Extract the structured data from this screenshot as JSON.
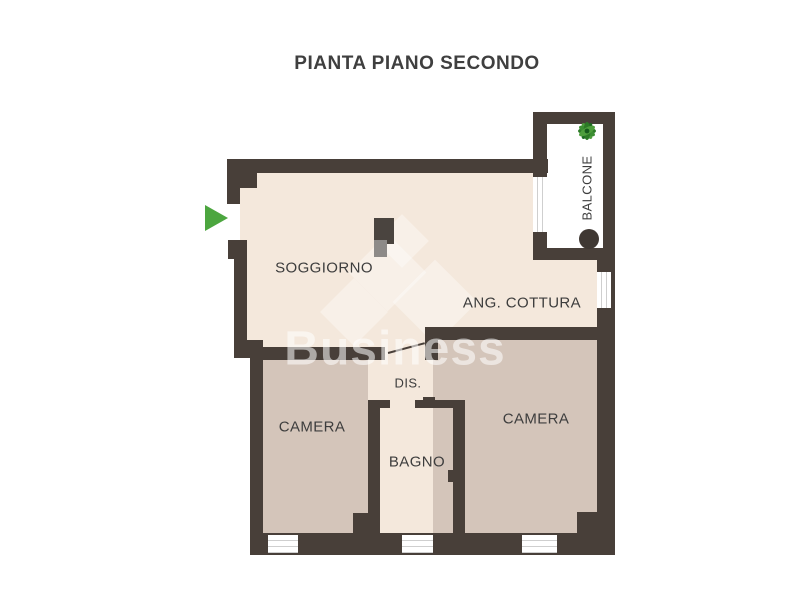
{
  "title": "PIANTA PIANO SECONDO",
  "watermark": {
    "text": "Business"
  },
  "rooms": {
    "soggiorno": {
      "label": "SOGGIORNO"
    },
    "ang_cottura": {
      "label": "ANG. COTTURA"
    },
    "dis": {
      "label": "DIS."
    },
    "camera_left": {
      "label": "CAMERA"
    },
    "camera_right": {
      "label": "CAMERA"
    },
    "bagno": {
      "label": "BAGNO"
    },
    "balcone": {
      "label": "BALCONE"
    }
  },
  "icons": {
    "entrance_arrow": "green-right-arrow",
    "plant": "green-plant",
    "balcony_marker": "dark-circle"
  },
  "colors": {
    "wall": "#483f39",
    "room_light": "#f4e8dc",
    "room_dark": "#d4c5ba",
    "balcony": "#ffffff",
    "accent_green": "#4ca63f",
    "text": "#3d3d3d"
  }
}
